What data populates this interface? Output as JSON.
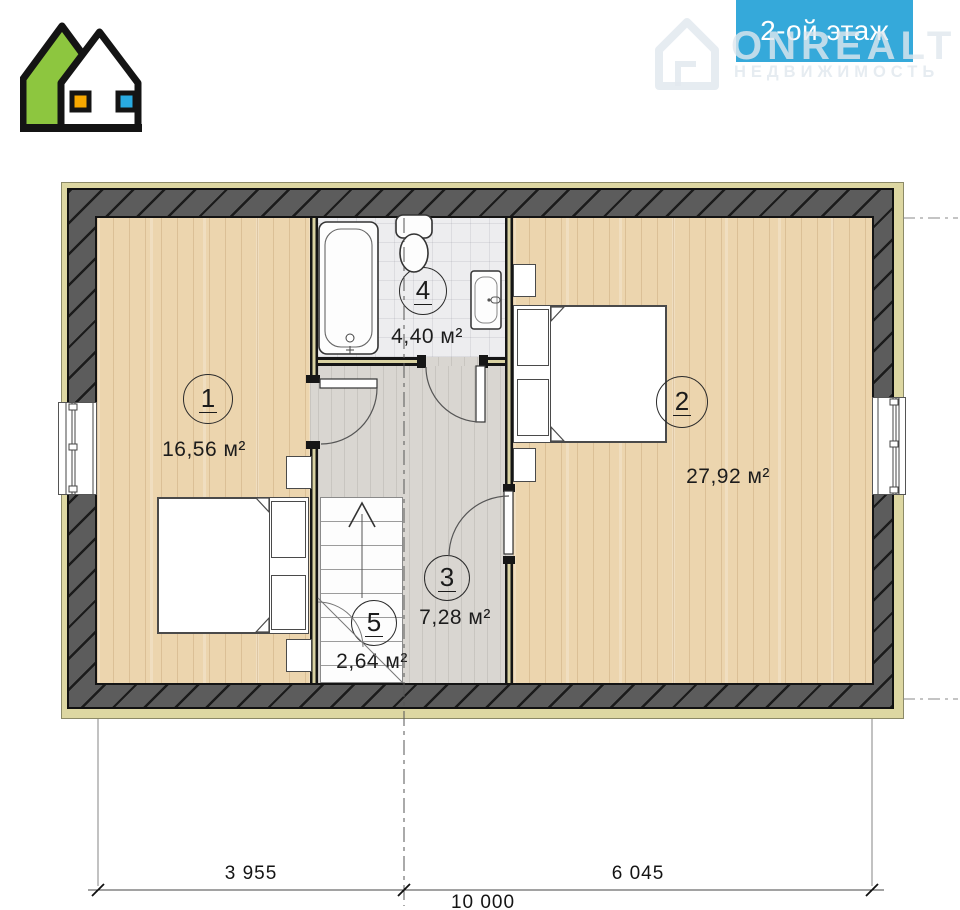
{
  "banner": {
    "label": "2-ой этаж",
    "bg_color": "#35a9da",
    "text_color": "#ffffff"
  },
  "watermark": {
    "brand": "ONREALT",
    "subtitle": "НЕДВИЖИМОСТЬ"
  },
  "logo": {
    "description": "two-house brand logo",
    "left_house_color": "#8dc63f",
    "right_house_color": "#ffffff",
    "left_window_color": "#f7a800",
    "right_window_color": "#29abe2",
    "outline_color": "#141414"
  },
  "rooms": [
    {
      "number": "1",
      "area": "16,56 м²",
      "type": "bedroom-left"
    },
    {
      "number": "2",
      "area": "27,92 м²",
      "type": "bedroom-right"
    },
    {
      "number": "3",
      "area": "7,28 м²",
      "type": "hall"
    },
    {
      "number": "4",
      "area": "4,40 м²",
      "type": "bathroom"
    },
    {
      "number": "5",
      "area": "2,64 м²",
      "type": "stairs"
    }
  ],
  "dimensions": {
    "left": "3 955",
    "right": "6 045",
    "total": "10 000"
  },
  "plan_colors": {
    "wood_floor": "#ecd5ae",
    "hall_floor": "#d9d6d1",
    "tile_floor": "#ededef",
    "wall_hatch": "#5c5c5c",
    "timber_strip": "#ddd7a2"
  }
}
